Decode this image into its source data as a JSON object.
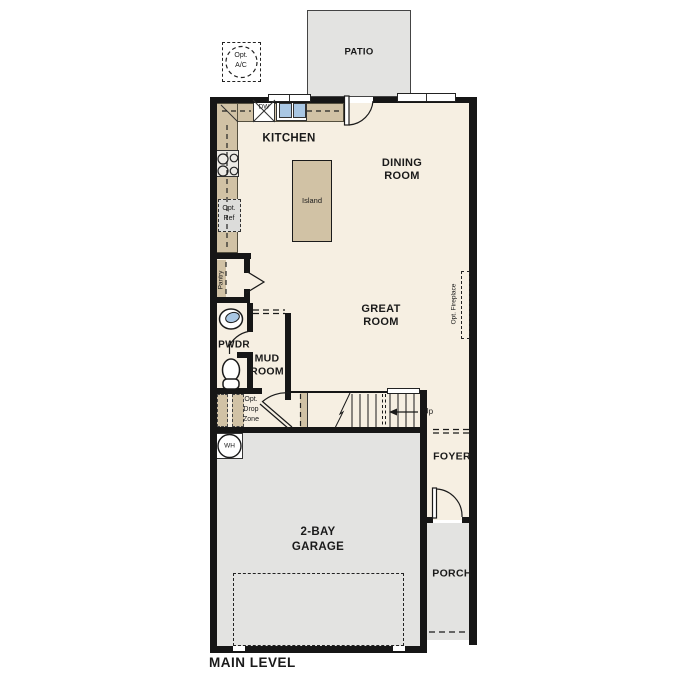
{
  "colors": {
    "floor": "#f6efe2",
    "counter": "#d1c2a5",
    "concrete": "#e3e3e1",
    "wall": "#161616",
    "water": "#a9c7e4",
    "appliance": "#dcdcda"
  },
  "plan": {
    "patio": "PATIO",
    "opt_ac": {
      "l1": "Opt.",
      "l2": "A/C"
    },
    "kitchen": "KITCHEN",
    "dw": "DW",
    "island": "Island",
    "dining": {
      "l1": "DINING",
      "l2": "ROOM"
    },
    "great": {
      "l1": "GREAT",
      "l2": "ROOM"
    },
    "opt_fireplace": "Opt. Fireplace",
    "pantry": "Pantry",
    "opt_ref": {
      "l1": "Opt.",
      "l2": "Ref"
    },
    "pwdr": "PWDR",
    "mud": {
      "l1": "MUD",
      "l2": "ROOM"
    },
    "opt_drop": {
      "l1": "Opt.",
      "l2": "Drop",
      "l3": "Zone"
    },
    "wh": "WH",
    "up": "Up",
    "foyer": "FOYER",
    "garage": {
      "l1": "2-BAY",
      "l2": "GARAGE"
    },
    "porch": "PORCH",
    "main_level": "MAIN LEVEL"
  }
}
